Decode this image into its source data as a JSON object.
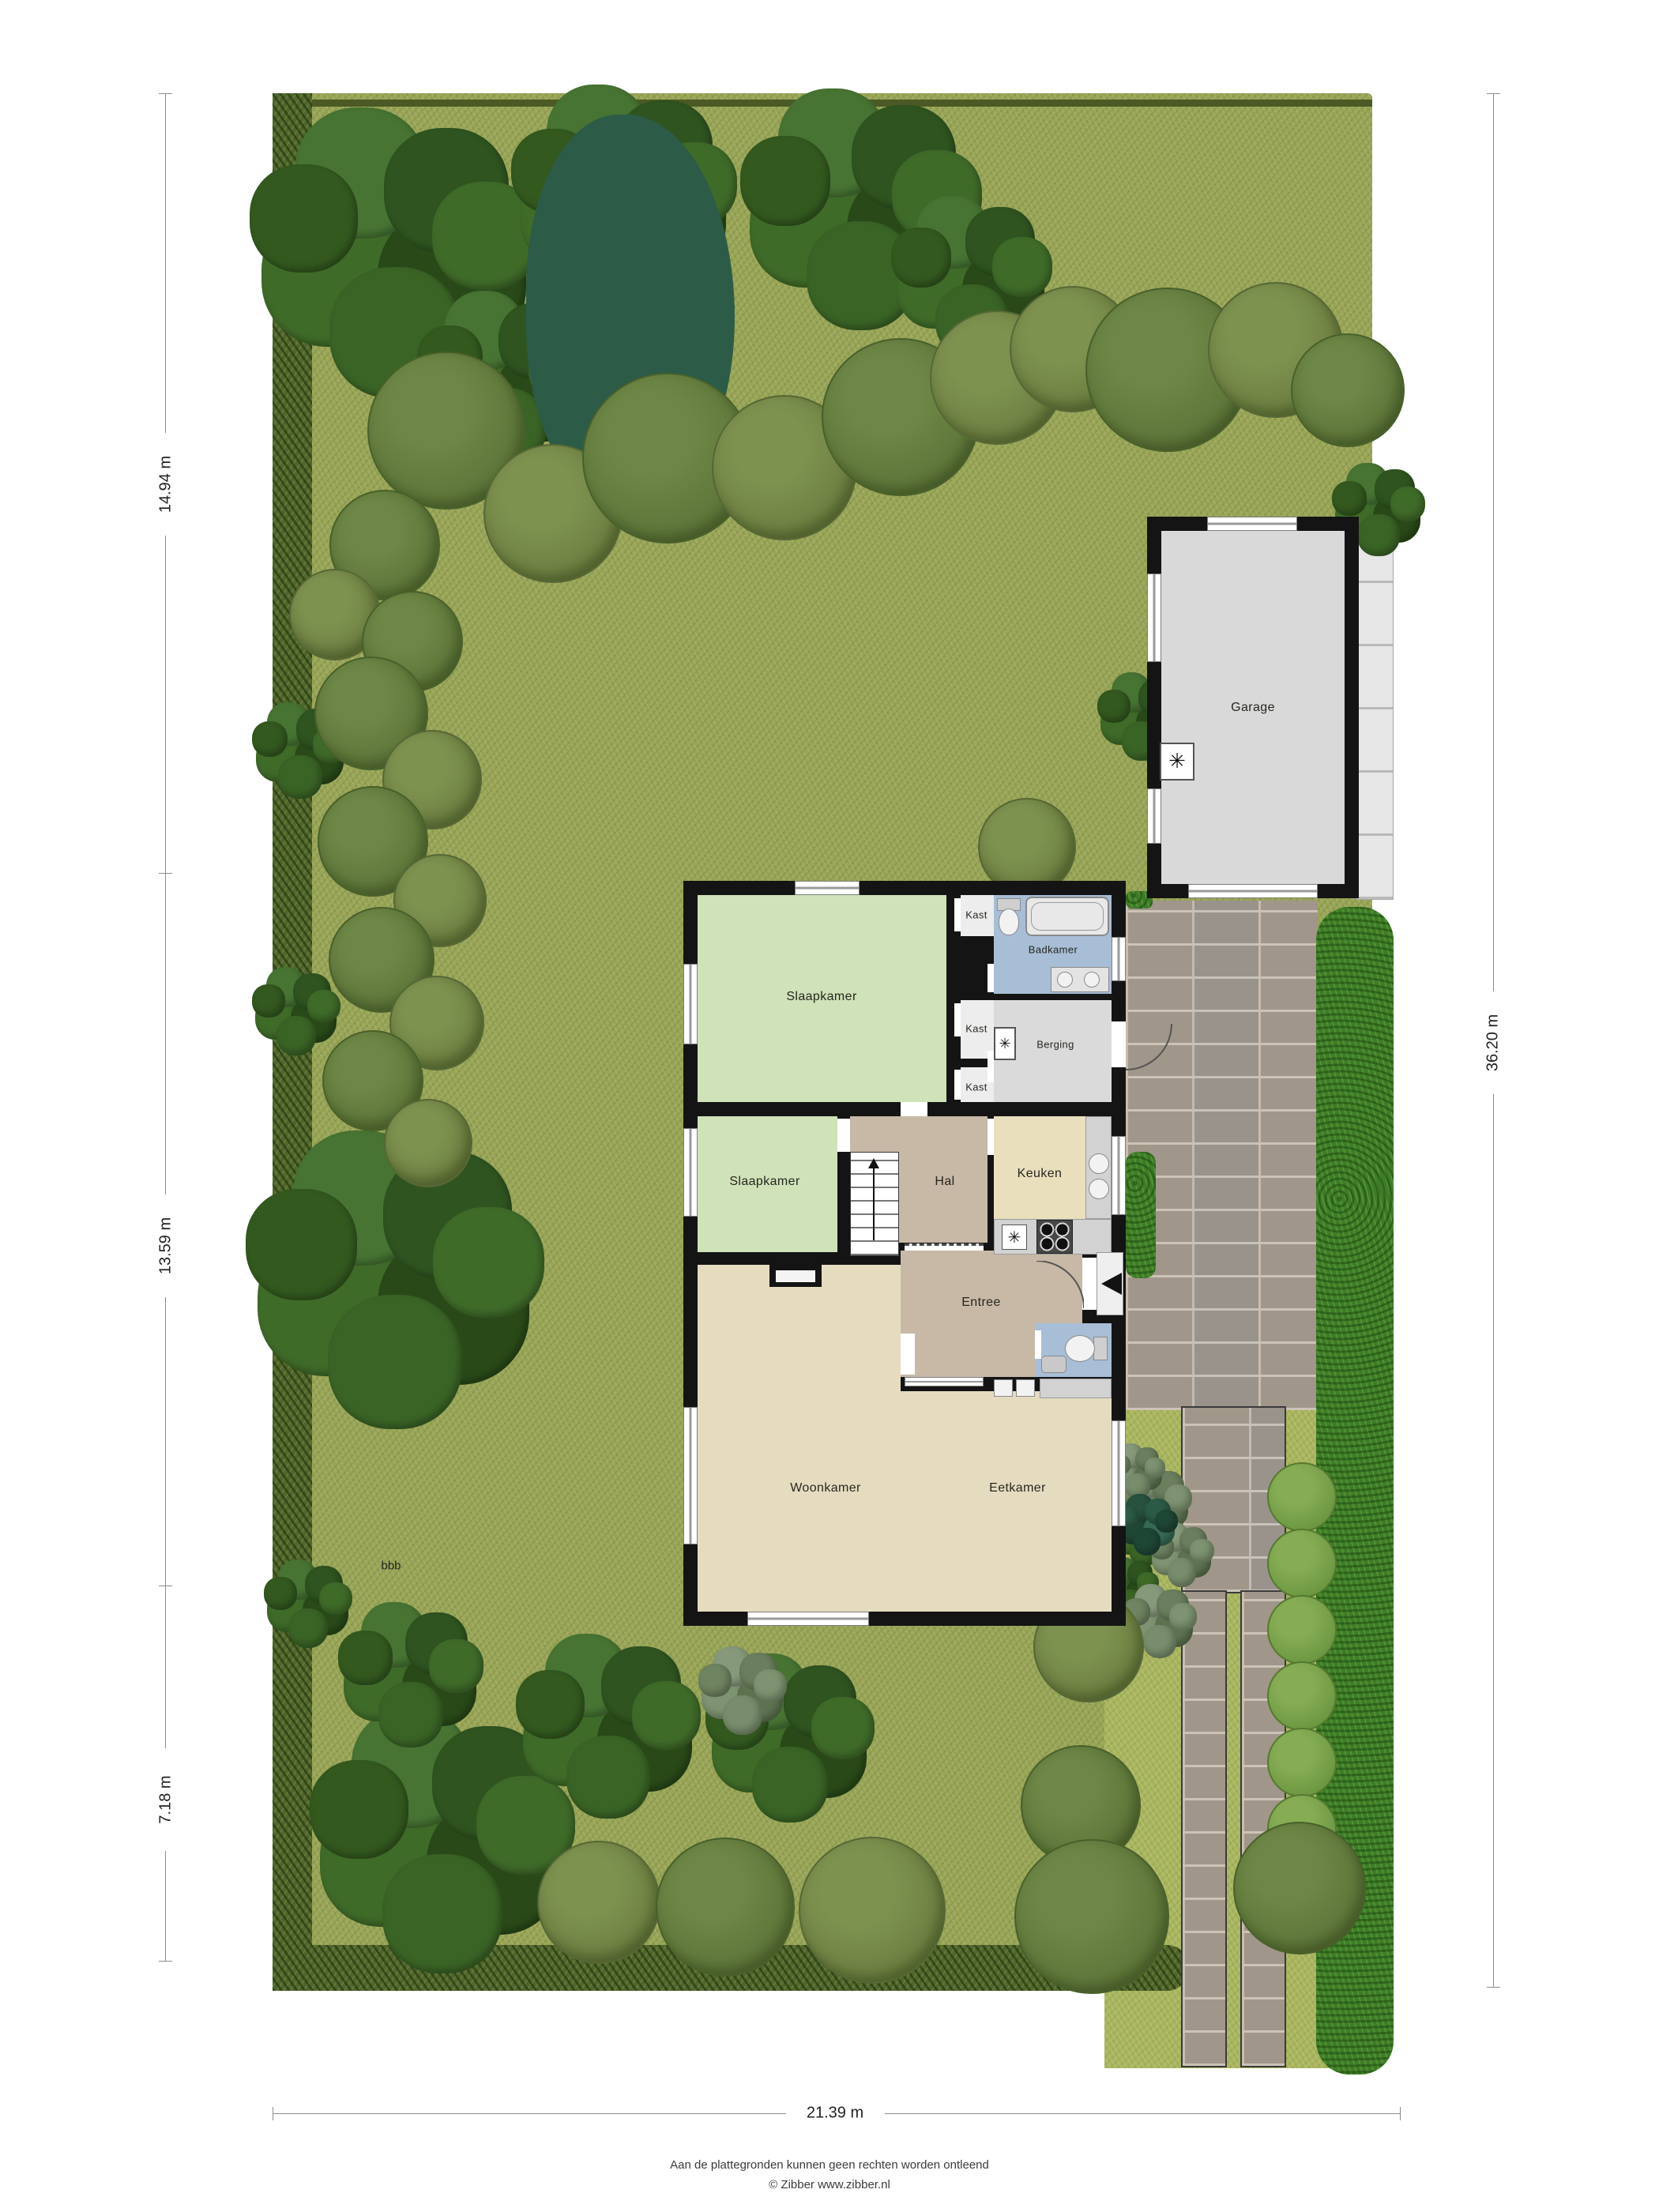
{
  "rooms": {
    "garage": "Garage",
    "slaapkamer": "Slaapkamer",
    "kast": "Kast",
    "badkamer": "Badkamer",
    "berging": "Berging",
    "hal": "Hal",
    "keuken": "Keuken",
    "entree": "Entree",
    "woonkamer": "Woonkamer",
    "eetkamer": "Eetkamer"
  },
  "dimensions": {
    "left_top": "14.94 m",
    "left_middle": "13.59 m",
    "left_bottom": "7.18 m",
    "right": "36.20 m",
    "bottom": "21.39 m"
  },
  "annotations": {
    "stray_text": "bbb"
  },
  "footer": {
    "disclaimer": "Aan de plattegronden kunnen geen rechten worden ontleend",
    "credit": "© Zibber www.zibber.nl"
  },
  "colors": {
    "grass": "#97a356",
    "hedge_dark": "#50662b",
    "hedge_bright": "#3f7c27",
    "pavers": "#a29b90",
    "sidewalk": "#e6e6e6",
    "wall": "#141414",
    "rooms": {
      "slaapkamer": "#cfe2b8",
      "badkamer": "#a7bed6",
      "toilet": "#a7bed6",
      "berging": "#dadada",
      "kast": "#ededed",
      "hal": "#c7b9a6",
      "entree": "#c7b9a6",
      "keuken": "#eadfbd",
      "woonkamer": "#e5dcc0",
      "garage": "#d9d9d9"
    }
  }
}
